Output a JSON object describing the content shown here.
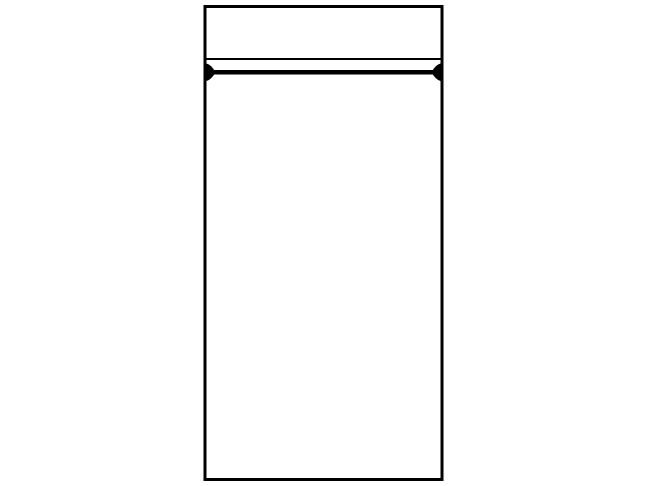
{
  "figure": {
    "title": "Zip-lock bag line drawing",
    "colors": {
      "line": "#000000",
      "fill": "#ffffff",
      "canvas": "#ffffff"
    }
  }
}
